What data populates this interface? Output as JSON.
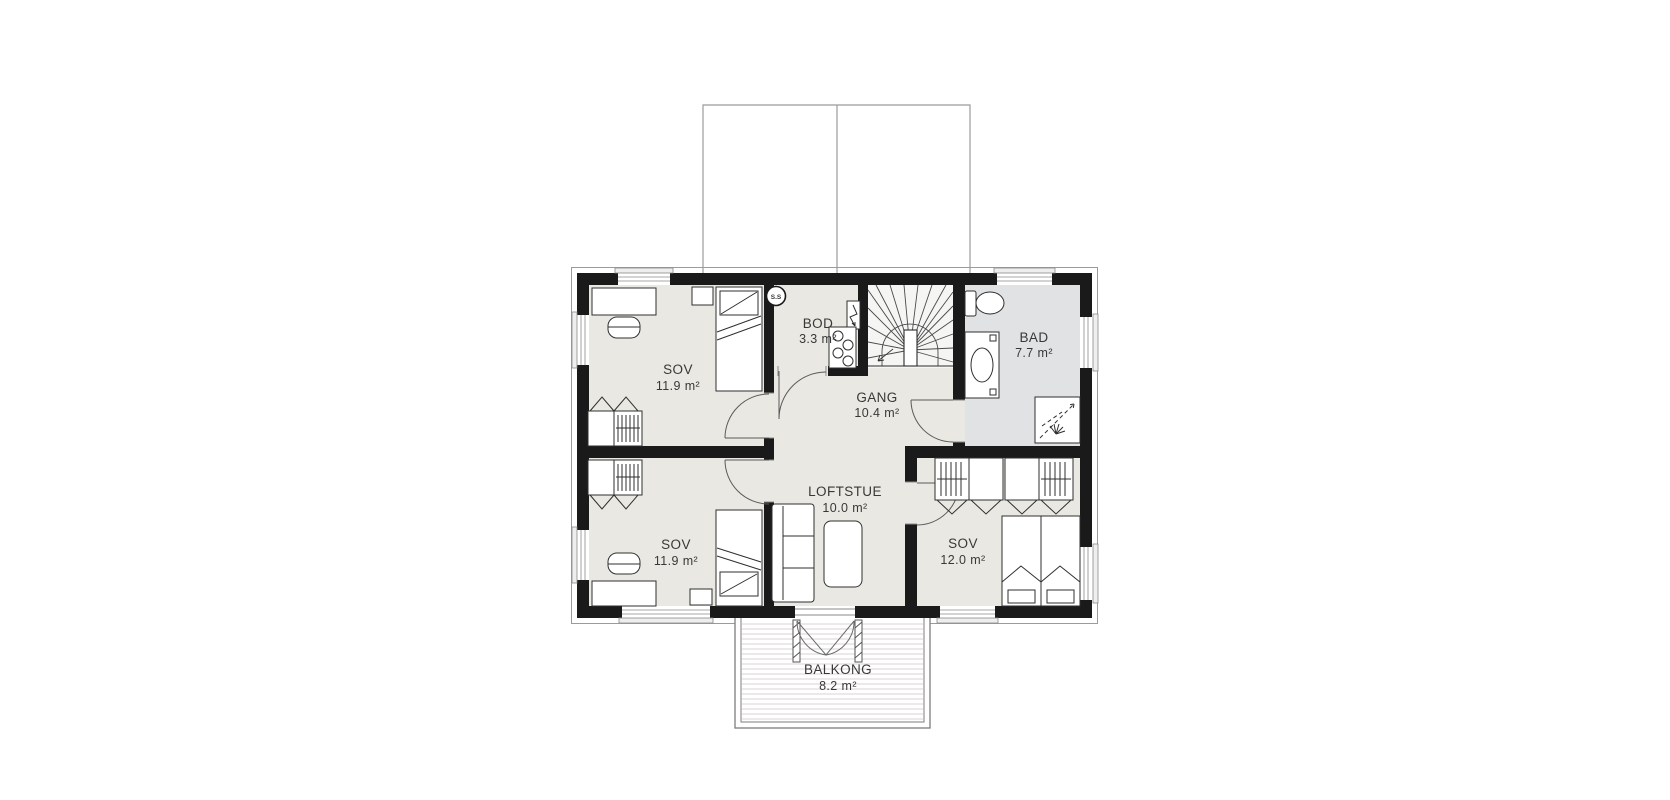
{
  "plan": {
    "type": "floorplan",
    "rooms": [
      {
        "id": "sov-upper-left",
        "name": "SOV",
        "area": "11.9 m²"
      },
      {
        "id": "bod",
        "name": "BOD",
        "area": "3.3 m²"
      },
      {
        "id": "bad",
        "name": "BAD",
        "area": "7.7 m²"
      },
      {
        "id": "gang",
        "name": "GANG",
        "area": "10.4 m²"
      },
      {
        "id": "sov-lower-left",
        "name": "SOV",
        "area": "11.9 m²"
      },
      {
        "id": "loftstue",
        "name": "LOFTSTUE",
        "area": "10.0 m²"
      },
      {
        "id": "sov-right",
        "name": "SOV",
        "area": "12.0 m²"
      },
      {
        "id": "balkong",
        "name": "BALKONG",
        "area": "8.2 m²"
      }
    ],
    "markers": {
      "smoke_detector_label": "S.S"
    },
    "colors": {
      "wall": "#1a1a1a",
      "room_fill": "#eae8e2",
      "bath_fill": "#e1e2e4",
      "stair_fill": "#f5f5f3",
      "thin_line": "#8a8a8a",
      "roof_line": "#9b9b9b",
      "deck_line": "#d7d6d1",
      "text": "#383838"
    }
  }
}
